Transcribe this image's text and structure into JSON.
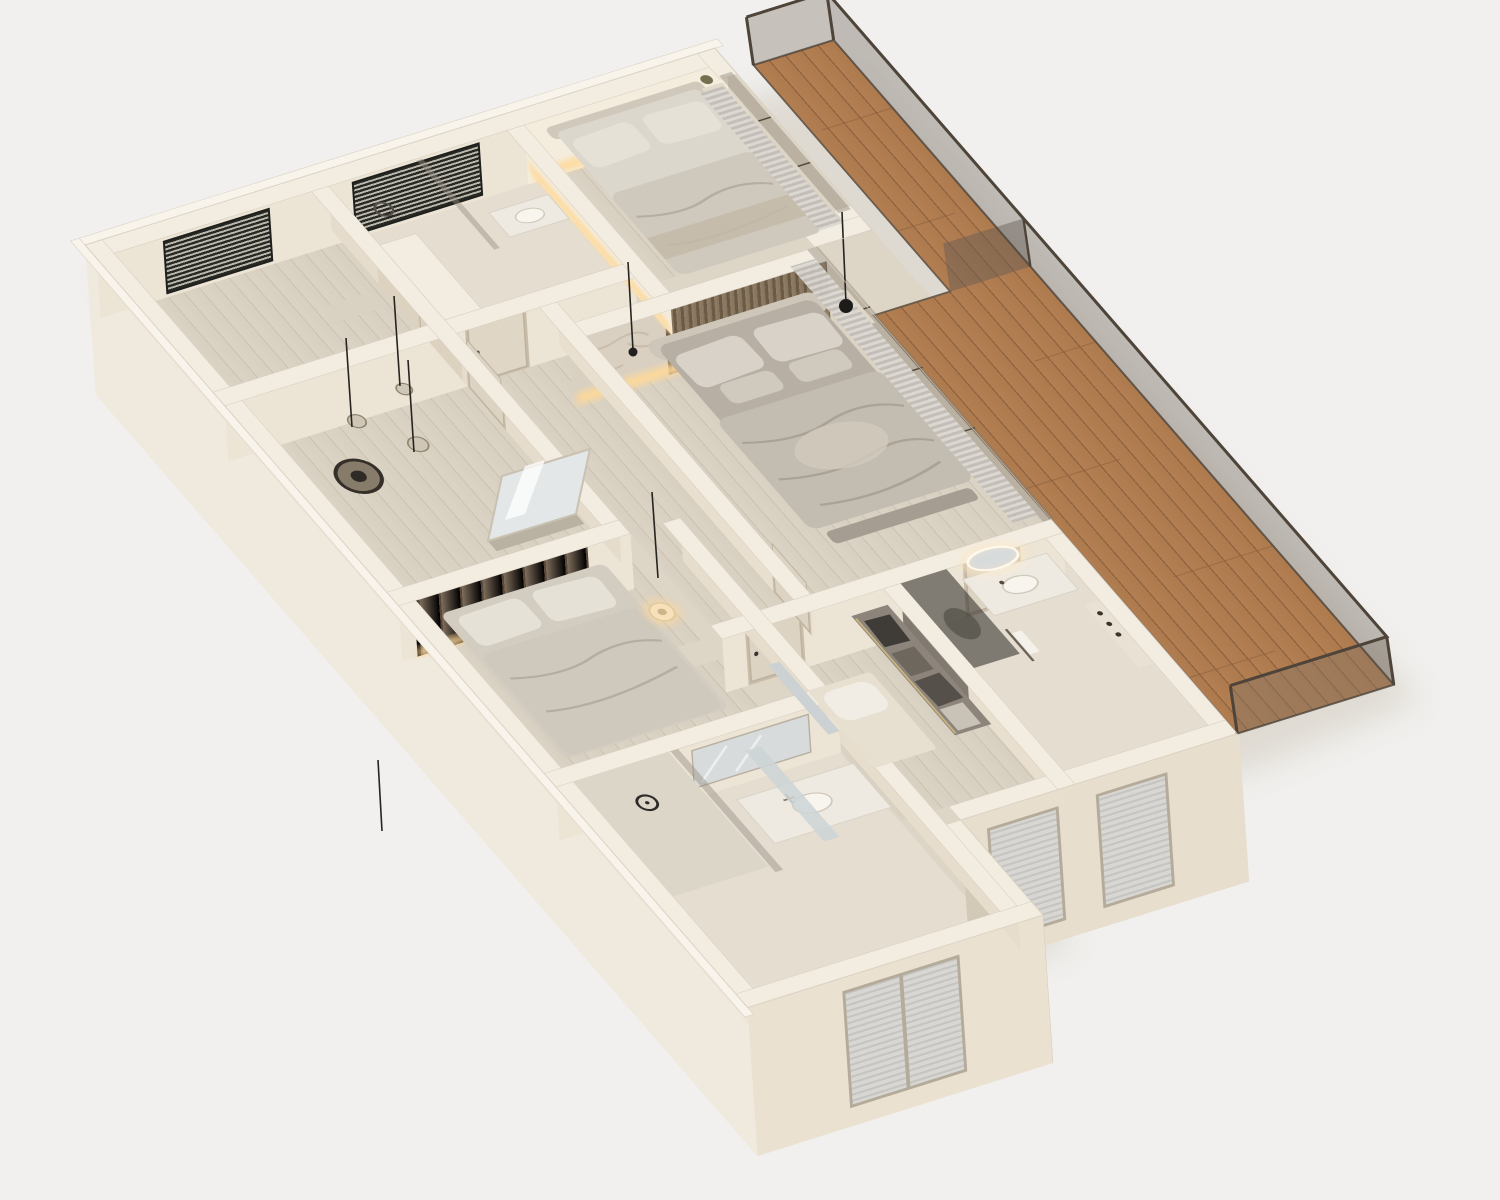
{
  "scene": {
    "kind": "3d-floor-plan-render",
    "view": "top-down axonometric cutaway",
    "style": "minimal beige apartment with wrap-around wooden terrace"
  },
  "colors": {
    "background": "#f1f0ee",
    "slab_floor": "#ddd5c6",
    "room_tile": "#e4ddd0",
    "wall_top": "#f2ece1",
    "wall_top_lip": "#f8f4eb",
    "wall_face_lit": "#ece4d5",
    "wall_face_shadow": "#d3c9b7",
    "outer_face_west": "#f0e9dd",
    "outer_face_se": "#e7decd",
    "outer_face_annex": "#eae1d0",
    "terrace_frame": "#4e443a",
    "glass_tint": "rgba(128,118,106,0.38)",
    "bed_linen_light": "#e6e1d7",
    "bed_linen_mid": "#cfc8bc",
    "bed_base": "#b7afa3",
    "duvet_master": "#c3bcb0",
    "accent_stone": "#d9d0c1",
    "accent_wood": "#8a7866",
    "glow_warm": "#ffd998",
    "mirror_glass": "#d7dbdb",
    "vanity_white": "#efeae1",
    "lamp_black": "#1c1b19",
    "shadow_soft": "#c9c1b2",
    "shower_glass_dark": "rgba(42,39,35,0.55)",
    "wood_dark_band": "#7d6c5a",
    "clothes_dark": "#3f3b36"
  },
  "regions": [
    {
      "name": "entry-wardrobe-room",
      "objects": [
        "blinds-window",
        "console"
      ]
    },
    {
      "name": "hall",
      "objects": [
        "pendant-lamps",
        "round-tray",
        "leaning-mirror"
      ]
    },
    {
      "name": "bathroom-top",
      "objects": [
        "blinds-window",
        "shower",
        "vanity"
      ]
    },
    {
      "name": "bedroom-1",
      "objects": [
        "single-bed",
        "backlit-wall",
        "curtains",
        "plant-shelf"
      ]
    },
    {
      "name": "master-bedroom",
      "objects": [
        "double-bed",
        "slat-headboard",
        "stone-accent",
        "nightstand-lamp",
        "floor-lamp",
        "curtains",
        "bench"
      ]
    },
    {
      "name": "master-bathroom",
      "objects": [
        "oval-backlit-mirror",
        "vanity-sink",
        "dark-glass-shower",
        "niche-shelf",
        "towel-rail"
      ]
    },
    {
      "name": "walk-in-closet",
      "objects": [
        "hanging-clothes",
        "island-bench",
        "cushion",
        "mirror-panel"
      ]
    },
    {
      "name": "bedroom-2",
      "objects": [
        "double-bed",
        "wood-wardrobe-band",
        "pendant-lamp",
        "nightstand"
      ]
    },
    {
      "name": "bathroom-2",
      "objects": [
        "rain-shower",
        "vanity-sink",
        "mirror",
        "window"
      ]
    },
    {
      "name": "terrace",
      "objects": [
        "wood-plank-deck",
        "glass-railing",
        "glass-partition"
      ]
    }
  ]
}
